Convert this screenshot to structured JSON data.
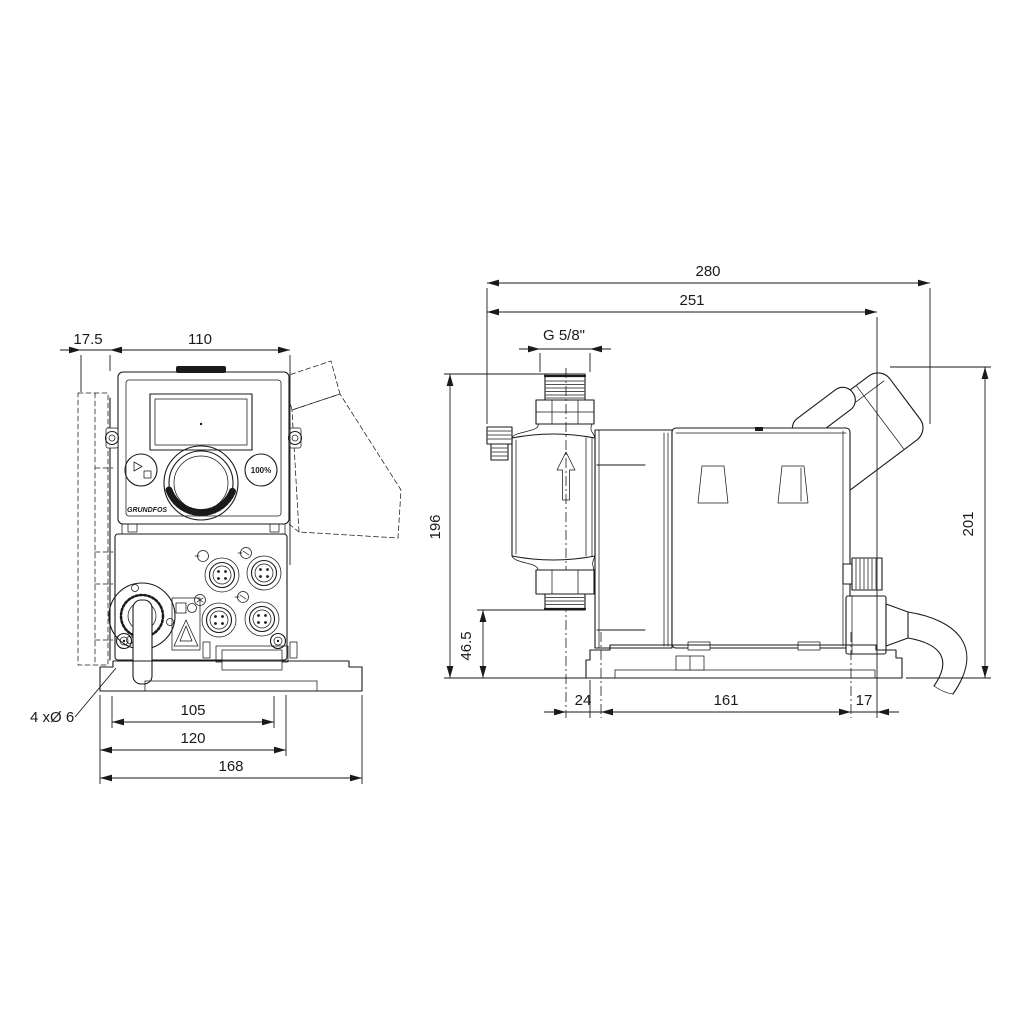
{
  "front_view": {
    "dim_wall_offset": "17.5",
    "dim_housing_width": "110",
    "dim_slot_spacing": "105",
    "dim_plate_width": "120",
    "dim_baseplate_width": "168",
    "mounting_holes_note": "4 xØ 6",
    "panel": {
      "percent_button": "100%",
      "brand": "GRUNDFOS"
    }
  },
  "side_view": {
    "dim_overall_depth": "280",
    "dim_depth_to_cable_gland": "251",
    "dim_connection_thread": "G 5/8\"",
    "dim_height_to_discharge": "196",
    "dim_suction_valve_height": "46.5",
    "dim_overall_height": "201",
    "dim_base_front_offset": "24",
    "dim_mounting_hole_spacing": "161",
    "dim_base_rear_offset": "17"
  }
}
